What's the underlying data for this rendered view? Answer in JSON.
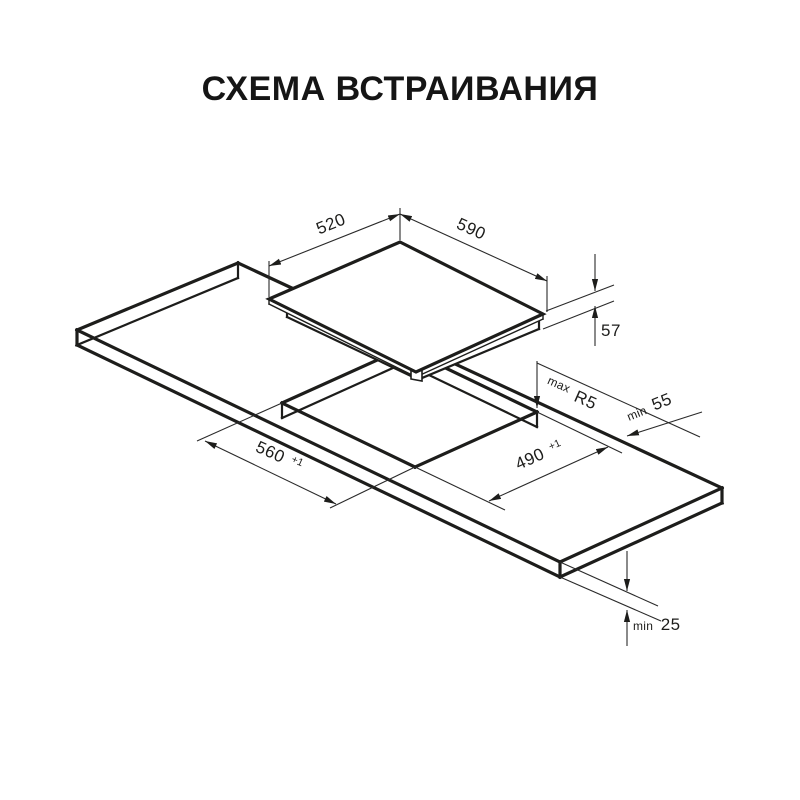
{
  "title": "СХЕМА ВСТРАИВАНИЯ",
  "colors": {
    "background": "#ffffff",
    "line": "#1d1d1b",
    "text": "#151515"
  },
  "diagram": {
    "dimensions": {
      "cooktop_depth": {
        "value": "520"
      },
      "cooktop_width": {
        "value": "590"
      },
      "cooktop_height": {
        "value": "57"
      },
      "cutout_corner_radius": {
        "prefix": "max",
        "value": "R5"
      },
      "rear_clearance": {
        "prefix": "min",
        "value": "55"
      },
      "cutout_depth": {
        "value": "560",
        "tolerance": "+1"
      },
      "cutout_width": {
        "value": "490",
        "tolerance": "+1"
      },
      "front_clearance": {
        "prefix": "min",
        "value": "25"
      }
    }
  }
}
